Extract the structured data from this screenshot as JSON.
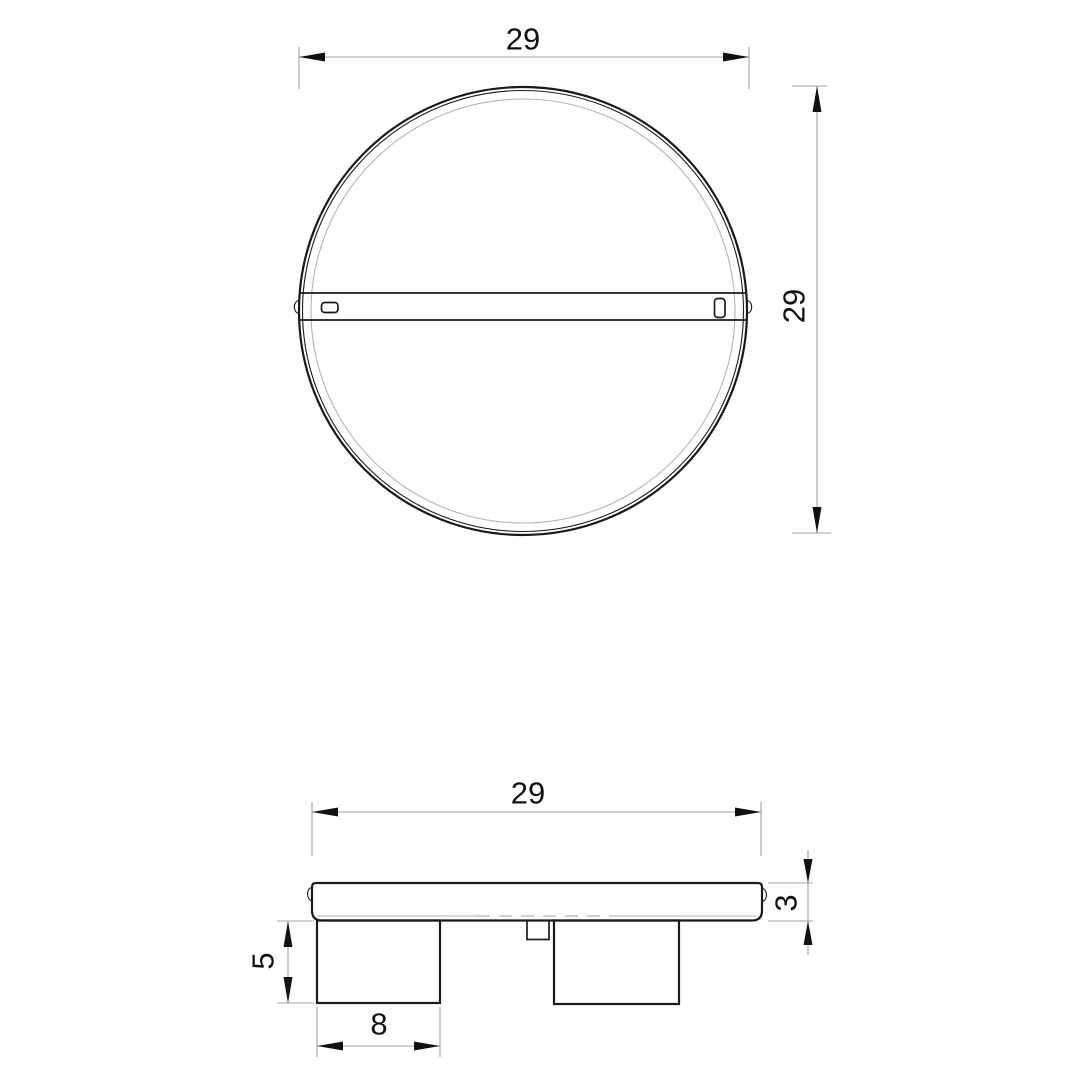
{
  "drawing": {
    "type": "technical-dimension-drawing",
    "subject": "round-ceiling-light-fixture",
    "views": {
      "top": {
        "width_label": "29",
        "height_label": "29"
      },
      "side": {
        "width_label": "29",
        "thickness_label": "3",
        "spot_height_label": "5",
        "spot_width_label": "8"
      }
    }
  },
  "colors": {
    "background": "#ffffff",
    "object_line": "#1a1a1a",
    "faint_line": "#b4b4b4",
    "dim_line": "#a3a3a3",
    "text": "#111111"
  }
}
